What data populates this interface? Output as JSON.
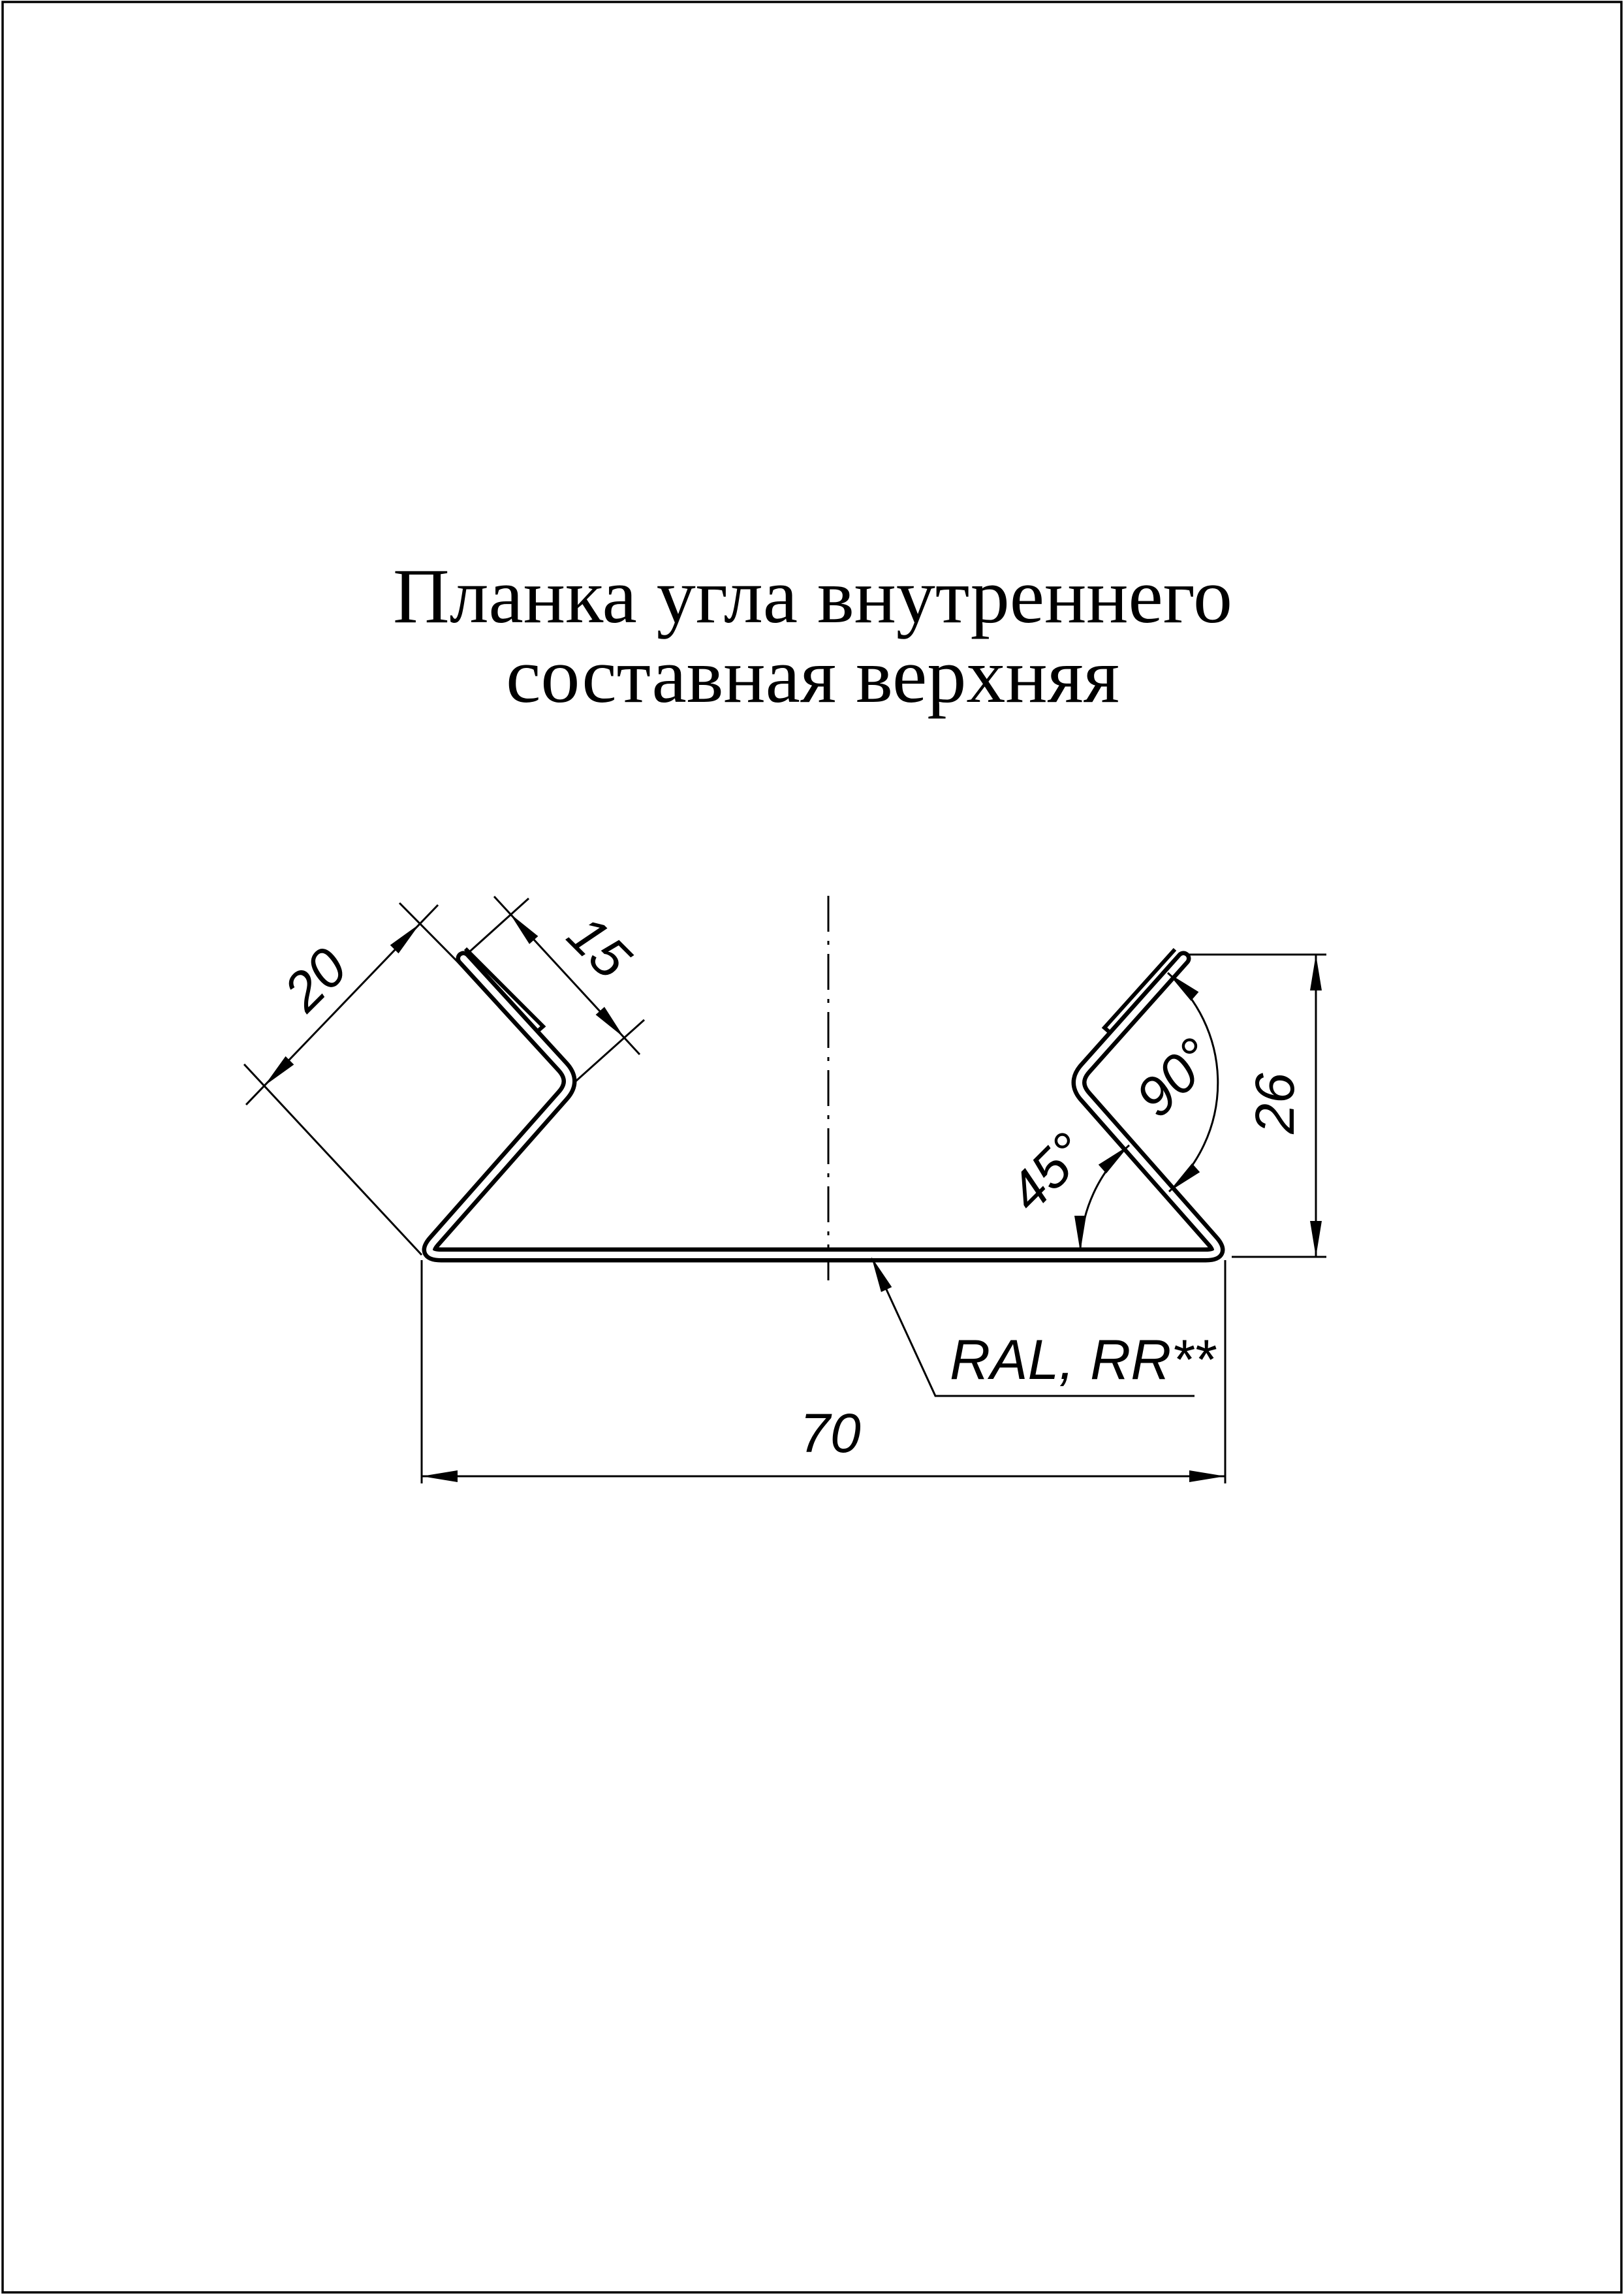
{
  "title": {
    "line1": "Планка угла внутреннего",
    "line2": "составная верхняя"
  },
  "dimensions": {
    "base_width": "70",
    "overall_height": "26",
    "flange_length": "20",
    "hem_length": "15",
    "bend_angle": "90°",
    "base_angle": "45°"
  },
  "material_label": "RAL, RR**",
  "colors": {
    "ink": "#000000",
    "paper": "#ffffff"
  }
}
